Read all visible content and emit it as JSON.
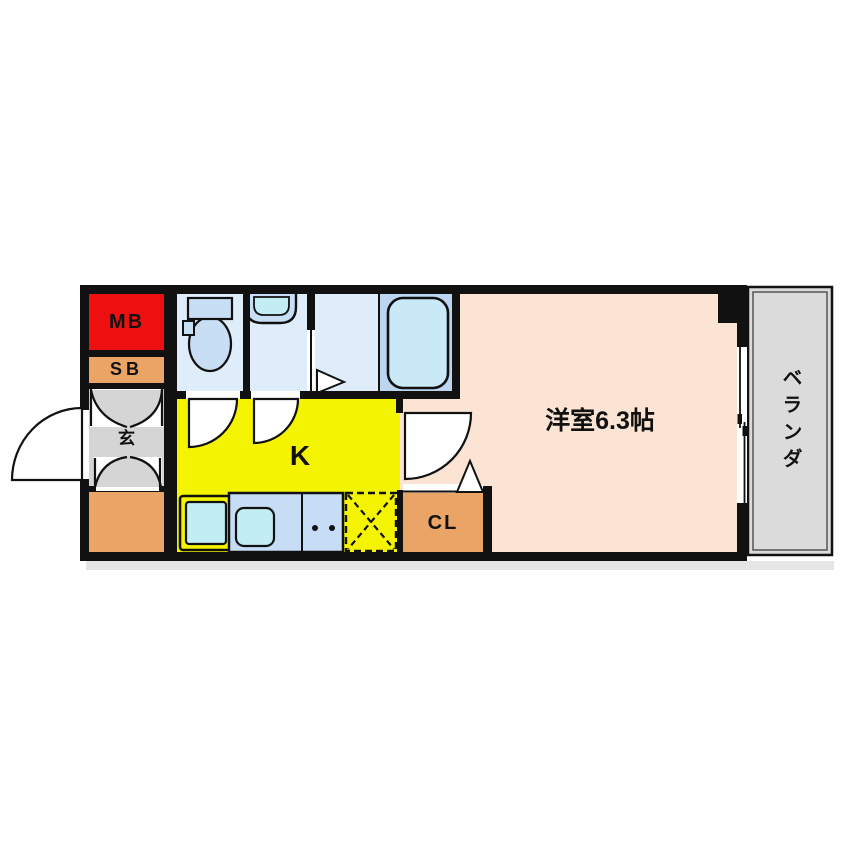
{
  "floorplan": {
    "labels": {
      "meter_box": "MB",
      "shoe_box": "SB",
      "entrance": "玄",
      "kitchen": "K",
      "closet": "CL",
      "main_room": "洋室6.3帖",
      "veranda": "ベランダ"
    },
    "colors": {
      "wall": "#111111",
      "meter_box_red": "#ee1010",
      "storage_orange": "#e9a466",
      "entrance_gray": "#d5d5d5",
      "kitchen_yellow": "#f5f400",
      "room_pink": "#fbe4d4",
      "bathroom_blue": "#dfecfa",
      "bath_area_blue": "#bcd5f0",
      "fixture_blue": "#c8def4",
      "counter_blue": "#c6ddf5",
      "basin_cyan": "#c2edf3",
      "tub_cyan": "#c9e9f6",
      "veranda_gray": "#dbdbdb",
      "door_white": "#ffffff"
    }
  }
}
